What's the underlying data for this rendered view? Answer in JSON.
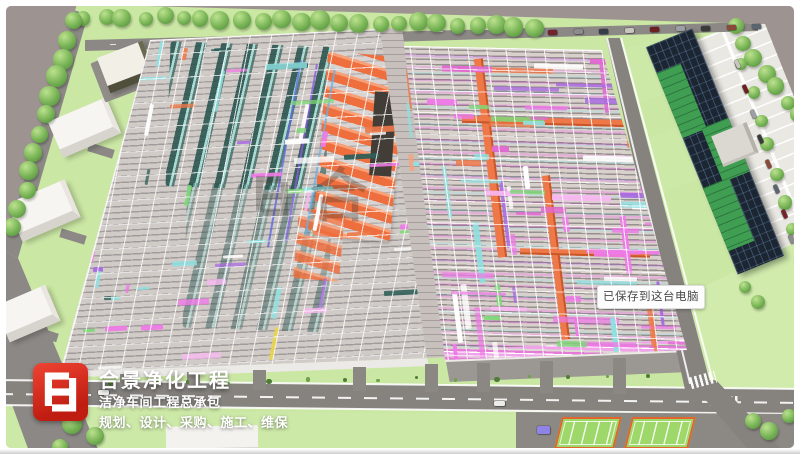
{
  "branding": {
    "company_name": "合景净化工程",
    "tagline": "洁净车间工程总承包",
    "services": "规划、设计、采购、施工、维保"
  },
  "toast": {
    "text": "已保存到这台电脑"
  },
  "watermark": {
    "glyph": "合"
  },
  "palette": {
    "background": "#9d9491",
    "lawn": "#cbe7a4",
    "road": "#86837f",
    "hall_deck": "#d0cac7",
    "duct_orange": "#ef7040",
    "pipe_magenta": "#ee7ae6",
    "pipe_cyan": "#8fe0e0",
    "pipe_violet": "#a86ae0",
    "pipe_green": "#7fd878",
    "pipe_yellow": "#e8d44a",
    "equipment_teal": "#2f5f58",
    "glass_dark": "#1c2633",
    "glass_green": "#3f9e52",
    "logo_red": "#d6281a",
    "parking": "#eae8e2",
    "court_green": "#9fd86a",
    "court_border": "#e0662e"
  },
  "scene": {
    "tree_rows": [
      {
        "x1": 85,
        "y1": 16,
        "x2": 535,
        "y2": 26,
        "n": 24,
        "rmin": 7,
        "rmax": 10
      },
      {
        "x1": 74,
        "y1": 20,
        "x2": 14,
        "y2": 228,
        "n": 12,
        "rmin": 8,
        "rmax": 11
      },
      {
        "x1": 733,
        "y1": 28,
        "x2": 800,
        "y2": 116,
        "n": 7,
        "rmin": 7,
        "rmax": 9
      },
      {
        "x1": 744,
        "y1": 64,
        "x2": 800,
        "y2": 256,
        "n": 8,
        "rmin": 6,
        "rmax": 8
      }
    ],
    "single_trees": [
      [
        72,
        424,
        10
      ],
      [
        95,
        436,
        9
      ],
      [
        60,
        447,
        8
      ],
      [
        753,
        421,
        8
      ],
      [
        769,
        431,
        9
      ],
      [
        789,
        416,
        7
      ],
      [
        745,
        287,
        6
      ],
      [
        758,
        302,
        7
      ]
    ],
    "car_colors": [
      "#74232d",
      "#8c8c8c",
      "#343c47",
      "#c8c5bf",
      "#6d1f1f",
      "#9aa0a6",
      "#3a3a3a",
      "#8a4a3a",
      "#5a6570"
    ],
    "parked_rows": [
      {
        "x1": 548,
        "y1": 30,
        "x2": 752,
        "y2": 24,
        "n": 9,
        "rot": -2,
        "w": 9,
        "h": 4.5
      },
      {
        "x1": 733,
        "y1": 62,
        "x2": 795,
        "y2": 262,
        "n": 9,
        "rot": 66,
        "w": 9,
        "h": 4
      }
    ],
    "road_cars": [
      {
        "x": 98,
        "y": 390,
        "w": 11,
        "h": 5,
        "color": "#f2f2f0"
      },
      {
        "x": 494,
        "y": 401,
        "w": 11,
        "h": 5,
        "color": "#ececea"
      },
      {
        "x": 537,
        "y": 426,
        "w": 13,
        "h": 8,
        "color": "#8f83e8"
      }
    ],
    "bush_count": 16,
    "stub_xs": [
      120,
      187,
      253,
      353,
      425,
      477,
      540,
      613
    ],
    "top_dashes": {
      "x1": 110,
      "y1": 44,
      "x2": 530,
      "y2": 27,
      "n": 10
    },
    "curve_dashes": [
      [
        40,
        398
      ],
      [
        50,
        386
      ],
      [
        62,
        374
      ],
      [
        76,
        364
      ]
    ],
    "pipe_regions": [
      {
        "target": "hall-left-strips",
        "n": 48,
        "bbox": [
          135,
          40,
          280,
          320
        ],
        "hrot": -3,
        "vrot": 11,
        "vprob": 0.3,
        "ypow": 1.7,
        "lmin": 10,
        "lmax": 45,
        "tmin": 2.5,
        "tmax": 6,
        "palette": [
          [
            "#ee7ae6",
            20
          ],
          [
            "#8fe0e0",
            18
          ],
          [
            "#ffffff",
            14
          ],
          [
            "#7fd878",
            10
          ],
          [
            "#a86ae0",
            8
          ],
          [
            "#ef7848",
            8
          ],
          [
            "#2f5f58",
            10
          ],
          [
            "#e8d44a",
            4
          ],
          [
            "#f8b8f2",
            8
          ]
        ]
      },
      {
        "target": "hall-left-strips",
        "n": 16,
        "bbox": [
          65,
          245,
          85,
          125
        ],
        "hrot": -3,
        "vrot": 11,
        "vprob": 0.15,
        "ypow": 1,
        "lmin": 8,
        "lmax": 28,
        "tmin": 2.5,
        "tmax": 5,
        "palette": [
          [
            "#8fe0e0",
            22
          ],
          [
            "#ee7ae6",
            20
          ],
          [
            "#7fd878",
            14
          ],
          [
            "#ffffff",
            16
          ],
          [
            "#2f5f58",
            14
          ],
          [
            "#a86ae0",
            8
          ]
        ]
      },
      {
        "target": "hall-right-strips",
        "n": 72,
        "bbox": [
          412,
          48,
          270,
          300
        ],
        "hrot": 1.5,
        "vrot": -7,
        "vprob": 0.32,
        "ypow": 1,
        "lmin": 14,
        "lmax": 70,
        "tmin": 2.5,
        "tmax": 6.5,
        "palette": [
          [
            "#ee7ae6",
            26
          ],
          [
            "#f8b8f2",
            10
          ],
          [
            "#8fe0e0",
            16
          ],
          [
            "#ef7848",
            9
          ],
          [
            "#a86ae0",
            9
          ],
          [
            "#7fd878",
            7
          ],
          [
            "#e8d44a",
            4
          ],
          [
            "#ffffff",
            10
          ],
          [
            "#e06ad0",
            6
          ]
        ]
      },
      {
        "target": "corridor-strips",
        "n": 12,
        "bbox": [
          384,
          34,
          58,
          316
        ],
        "hrot": 0,
        "vrot": -6,
        "vprob": 0.7,
        "ypow": 1,
        "lmin": 14,
        "lmax": 44,
        "tmin": 3,
        "tmax": 7,
        "palette": [
          [
            "#ef7848",
            40
          ],
          [
            "#f7a078",
            14
          ],
          [
            "#8fe0e0",
            14
          ],
          [
            "#ee7ae6",
            16
          ],
          [
            "#ffffff",
            8
          ]
        ]
      }
    ]
  }
}
